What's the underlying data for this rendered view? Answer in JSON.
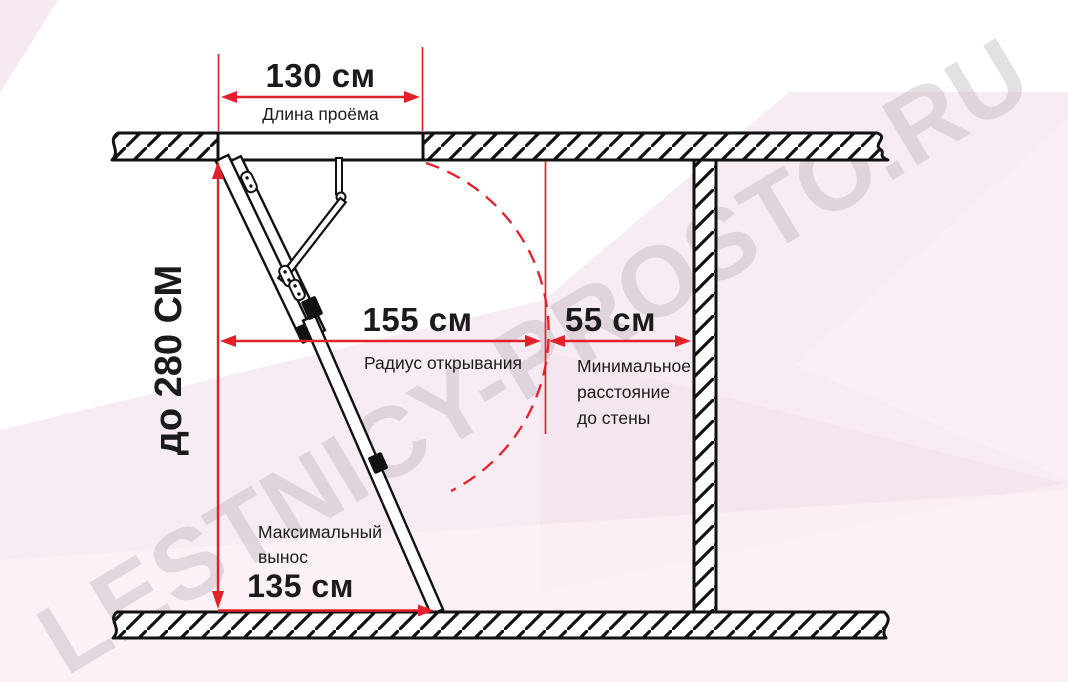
{
  "watermark": "LESTNICY-PROSTO.RU",
  "colors": {
    "accent_red": "#e2212b",
    "diagram_line": "#111111",
    "background_pink": "#f8ecf4",
    "watermark_gray": "rgba(156,143,155,0.27)"
  },
  "dimensions": {
    "opening": {
      "value": "130 см",
      "label": "Длина проёма"
    },
    "ceiling_height": {
      "value": "до 280 СМ"
    },
    "opening_radius": {
      "value": "155 см",
      "label": "Радиус открывания"
    },
    "wall_distance": {
      "value": "55 см",
      "label": "Минимальное\nрасстояние\nдо стены"
    },
    "max_extension": {
      "value": "135 см",
      "label": "Максимальный\nвынос"
    }
  }
}
